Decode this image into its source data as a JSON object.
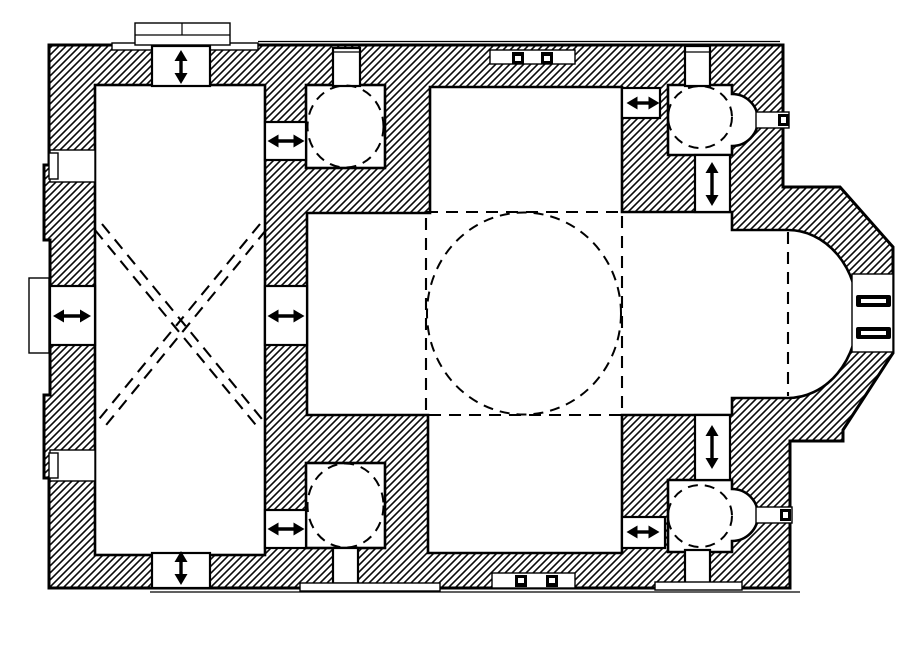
{
  "colors": {
    "background": "#ffffff",
    "ink": "#000000"
  },
  "plan": {
    "type": "architectural-floor-plan",
    "subject": "cross-in-square church plan with hatched masonry walls, dashed dome projections and double-headed door arrows",
    "rooms": [
      {
        "name": "narthex",
        "feature": "dashed diagonal cross (groin vault projection)"
      },
      {
        "name": "naos",
        "feature": "central dome shown as dashed circle inscribed in dashed square"
      },
      {
        "name": "northwest-corner-chamber",
        "feature": "dashed dome circle"
      },
      {
        "name": "southwest-corner-chamber",
        "feature": "dashed dome circle"
      },
      {
        "name": "northeast-chamber-prothesis",
        "feature": "dashed dome circle with eastern apsidiole and window slit"
      },
      {
        "name": "southeast-chamber-diakonikon",
        "feature": "dashed dome circle with eastern apsidiole and window slit"
      },
      {
        "name": "bema",
        "feature": "opens into main apse"
      },
      {
        "name": "main-apse",
        "feature": "semicircular interior, polygonal exterior, twin window bars"
      },
      {
        "name": "west-porch",
        "feature": "thin outlined steps at west door"
      },
      {
        "name": "north-steps",
        "feature": "stepped stair blocks outside north wall"
      }
    ],
    "arrows": [
      {
        "id": "north-narthex-door",
        "x": 181,
        "y": 67,
        "orient": "v",
        "len": 34
      },
      {
        "id": "south-narthex-door",
        "x": 181,
        "y": 568,
        "orient": "v",
        "len": 34
      },
      {
        "id": "west-entrance",
        "x": 72,
        "y": 316,
        "orient": "h",
        "len": 38
      },
      {
        "id": "narthex-to-nw-chamber",
        "x": 286,
        "y": 141,
        "orient": "h",
        "len": 37
      },
      {
        "id": "narthex-to-naos",
        "x": 286,
        "y": 316,
        "orient": "h",
        "len": 37
      },
      {
        "id": "narthex-to-sw-chamber",
        "x": 286,
        "y": 529,
        "orient": "h",
        "len": 37
      },
      {
        "id": "naos-to-ne-chamber",
        "x": 643,
        "y": 103,
        "orient": "h",
        "len": 33
      },
      {
        "id": "ne-chamber-to-bema",
        "x": 712,
        "y": 184,
        "orient": "v",
        "len": 44
      },
      {
        "id": "naos-to-se-chamber",
        "x": 643,
        "y": 532,
        "orient": "h",
        "len": 33
      },
      {
        "id": "se-chamber-to-bema",
        "x": 712,
        "y": 447,
        "orient": "v",
        "len": 44
      }
    ],
    "dashed_circles": [
      {
        "id": "central-dome",
        "cx": 524,
        "cy": 313.5,
        "rx": 97,
        "ry": 101
      },
      {
        "id": "nw-dome",
        "cx": 345.5,
        "cy": 126.5,
        "rx": 38,
        "ry": 41
      },
      {
        "id": "sw-dome",
        "cx": 345.5,
        "cy": 505.5,
        "rx": 38,
        "ry": 42
      },
      {
        "id": "ne-dome",
        "cx": 700,
        "cy": 117,
        "rx": 32,
        "ry": 31
      },
      {
        "id": "se-dome",
        "cx": 700,
        "cy": 516,
        "rx": 32,
        "ry": 31
      }
    ],
    "dashed_square": {
      "x": 426,
      "y": 212,
      "w": 196,
      "h": 203
    },
    "apse_chord": {
      "x": 788,
      "y1": 232,
      "y2": 396
    },
    "narthex_cross_lines": [
      [
        102,
        224,
        266,
        424
      ],
      [
        95,
        230,
        260,
        430
      ],
      [
        266,
        230,
        102,
        430
      ],
      [
        260,
        224,
        95,
        424
      ]
    ]
  }
}
